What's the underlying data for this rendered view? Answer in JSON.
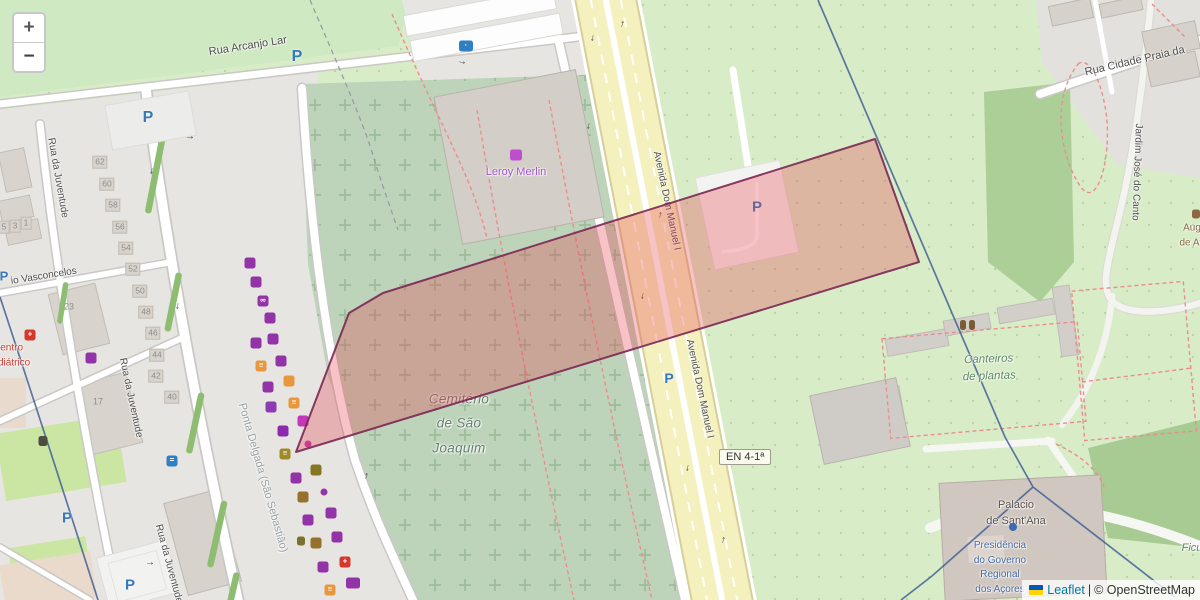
{
  "controls": {
    "zoom_in": "+",
    "zoom_out": "−"
  },
  "attribution": {
    "leaflet": "Leaflet",
    "separator": "|",
    "copyright": "© OpenStreetMap"
  },
  "badge": {
    "text": "EN 4-1ª"
  },
  "glyphs": {
    "parking": "P",
    "arrow": "→"
  },
  "colors": {
    "highlight_fill": "rgba(229,62,74,0.31)",
    "highlight_stroke": "rgba(122,39,83,0.9)",
    "boundary_blue": "#3a5a92",
    "road_yellow": "#f5f1bf",
    "parking_blue": "#3579bc",
    "shop_purple": "#9333a8",
    "food_orange": "#e8973c",
    "health_red": "#d6372c"
  },
  "labels": [
    {
      "name": "street-label-rua-arcanjo-lar",
      "text": "Rua Arcanjo Lar",
      "x": 248,
      "y": 47,
      "rot": -9,
      "size": 11
    },
    {
      "name": "street-label-rua-da-juventude-1",
      "text": "Rua da Juventude",
      "x": 57,
      "y": 178,
      "rot": 80,
      "size": 10
    },
    {
      "name": "street-label-rua-da-juventude-2",
      "text": "Rua da Juventude",
      "x": 130,
      "y": 398,
      "rot": 78,
      "size": 10
    },
    {
      "name": "street-label-rua-da-juventude-3",
      "text": "Rua da Juventude",
      "x": 168,
      "y": 564,
      "rot": 75,
      "size": 10
    },
    {
      "name": "street-label-vasconcelos",
      "text": "io Vasconcelos",
      "x": 44,
      "y": 277,
      "rot": -9,
      "size": 10
    },
    {
      "name": "poi-label-centro-pediatrico",
      "text": "Centro\nPediátrico",
      "x": 8,
      "y": 356,
      "rot": 0,
      "size": 10,
      "color": "#cc3a33",
      "cls": "tight"
    },
    {
      "name": "poi-label-leroy-merlin",
      "text": "Leroy Merlin",
      "x": 516,
      "y": 173,
      "rot": 0,
      "size": 11,
      "color": "#a055c8"
    },
    {
      "name": "area-label-cemiterio",
      "text": "Cemitério\nde São\nJoaquim",
      "x": 459,
      "y": 424,
      "rot": 0,
      "size": 13.5,
      "color": "#66806f",
      "cls": "italic cem-lbl"
    },
    {
      "name": "street-label-avenida-dom-manuel-1",
      "text": "Avenida Dom Manuel I",
      "x": 666,
      "y": 201,
      "rot": 78,
      "size": 10
    },
    {
      "name": "street-label-avenida-dom-manuel-2",
      "text": "Avenida Dom Manuel I",
      "x": 699,
      "y": 389,
      "rot": 78,
      "size": 10
    },
    {
      "name": "area-label-canteiros",
      "text": "Canteiros\nde plantas",
      "x": 989,
      "y": 368,
      "rot": -2,
      "size": 11.5,
      "color": "#5d8a60",
      "cls": "italic"
    },
    {
      "name": "street-label-rua-cidade-praia",
      "text": "Rua Cidade Praia da",
      "x": 1135,
      "y": 62,
      "rot": -13,
      "size": 11
    },
    {
      "name": "street-label-jardim-jose-do-canto",
      "text": "Jardim José do Canto",
      "x": 1136,
      "y": 172,
      "rot": 92,
      "size": 10
    },
    {
      "name": "poi-label-aug-de-atl",
      "text": "Aug\nde Atl",
      "x": 1192,
      "y": 236,
      "rot": 0,
      "size": 10,
      "color": "#8a6a45"
    },
    {
      "name": "poi-label-palacio",
      "text": "Palácio\nde Sant'Ana",
      "x": 1016,
      "y": 514,
      "rot": 0,
      "size": 11,
      "color": "#575048"
    },
    {
      "name": "poi-label-presidencia",
      "text": "Presidência\ndo Governo\nRegional\ndos Açores",
      "x": 1000,
      "y": 568,
      "rot": 0,
      "size": 10,
      "color": "#46699e",
      "cls": "tight"
    },
    {
      "name": "area-label-ponta-delgada",
      "text": "Ponta Delgada (São Sebastião)",
      "x": 262,
      "y": 478,
      "rot": 74,
      "size": 11,
      "color": "#9aa0a2"
    },
    {
      "name": "area-label-ficus",
      "text": "Ficu",
      "x": 1192,
      "y": 549,
      "rot": 0,
      "size": 11,
      "color": "#5f8a60",
      "cls": "italic"
    }
  ],
  "house_numbers": [
    {
      "name": "house-number",
      "text": "62",
      "x": 100,
      "y": 162
    },
    {
      "name": "house-number",
      "text": "60",
      "x": 107,
      "y": 184
    },
    {
      "name": "house-number",
      "text": "58",
      "x": 113,
      "y": 205
    },
    {
      "name": "house-number",
      "text": "56",
      "x": 120,
      "y": 227
    },
    {
      "name": "house-number",
      "text": "54",
      "x": 126,
      "y": 248
    },
    {
      "name": "house-number",
      "text": "52",
      "x": 133,
      "y": 269
    },
    {
      "name": "house-number",
      "text": "50",
      "x": 140,
      "y": 291
    },
    {
      "name": "house-number",
      "text": "48",
      "x": 146,
      "y": 312
    },
    {
      "name": "house-number",
      "text": "46",
      "x": 153,
      "y": 333
    },
    {
      "name": "house-number",
      "text": "44",
      "x": 157,
      "y": 355
    },
    {
      "name": "house-number",
      "text": "42",
      "x": 156,
      "y": 376
    },
    {
      "name": "house-number",
      "text": "40",
      "x": 172,
      "y": 397
    },
    {
      "name": "house-number",
      "text": "23",
      "x": 69,
      "y": 307,
      "cls": "numplain"
    },
    {
      "name": "house-number",
      "text": "17",
      "x": 98,
      "y": 402,
      "cls": "numplain"
    },
    {
      "name": "house-number",
      "text": "5",
      "x": 4,
      "y": 227
    },
    {
      "name": "house-number",
      "text": "3",
      "x": 15,
      "y": 226
    },
    {
      "name": "house-number",
      "text": "1",
      "x": 26,
      "y": 223
    }
  ],
  "parking_icons": [
    {
      "name": "parking-icon",
      "x": 148,
      "y": 118,
      "size": 16
    },
    {
      "name": "parking-icon",
      "x": 297,
      "y": 57,
      "size": 16
    },
    {
      "name": "parking-icon",
      "x": 4,
      "y": 276,
      "size": 13
    },
    {
      "name": "parking-icon",
      "x": 67,
      "y": 518,
      "size": 15
    },
    {
      "name": "parking-icon",
      "x": 130,
      "y": 585,
      "size": 15
    },
    {
      "name": "parking-icon",
      "x": 669,
      "y": 378,
      "size": 14
    },
    {
      "name": "parking-icon",
      "x": 757,
      "y": 207,
      "size": 15
    }
  ],
  "poi_icons": [
    {
      "name": "laundry-icon",
      "x": 250,
      "y": 263,
      "bg": "#9333a8"
    },
    {
      "name": "shop-bag-icon",
      "x": 256,
      "y": 282,
      "bg": "#9333a8"
    },
    {
      "name": "optician-icon",
      "x": 263,
      "y": 301,
      "bg": "#9333a8",
      "ch": "∞"
    },
    {
      "name": "clothes-shop-icon",
      "x": 270,
      "y": 318,
      "bg": "#9333a8"
    },
    {
      "name": "medical-shop-icon",
      "x": 256,
      "y": 343,
      "bg": "#9333a8"
    },
    {
      "name": "clothes-shop-icon",
      "x": 273,
      "y": 339,
      "bg": "#9333a8"
    },
    {
      "name": "fast-food-icon",
      "x": 261,
      "y": 366,
      "bg": "#e8973c",
      "ch": "≡"
    },
    {
      "name": "book-shop-icon",
      "x": 281,
      "y": 361,
      "bg": "#9333a8"
    },
    {
      "name": "clothes-shop-icon",
      "x": 268,
      "y": 387,
      "bg": "#9333a8"
    },
    {
      "name": "cafe-icon",
      "x": 289,
      "y": 381,
      "bg": "#e8973c"
    },
    {
      "name": "electronics-tv-icon",
      "x": 271,
      "y": 407,
      "bg": "#8d3bb0"
    },
    {
      "name": "fast-food-icon",
      "x": 294,
      "y": 403,
      "bg": "#e8973c",
      "ch": "≡"
    },
    {
      "name": "clothes-shop-icon",
      "x": 303,
      "y": 421,
      "bg": "#c238b8"
    },
    {
      "name": "clothes-shop-icon",
      "x": 283,
      "y": 431,
      "bg": "#8d2bb0"
    },
    {
      "name": "shop-dot-icon",
      "x": 308,
      "y": 444,
      "bg": "#c238b8",
      "cls": "dot",
      "w": 7,
      "h": 7
    },
    {
      "name": "fast-food-icon",
      "x": 285,
      "y": 454,
      "bg": "#a08a28",
      "ch": "≡"
    },
    {
      "name": "cinema-icon",
      "x": 316,
      "y": 470,
      "bg": "#857722"
    },
    {
      "name": "handbag-shop-icon",
      "x": 296,
      "y": 478,
      "bg": "#9333a8"
    },
    {
      "name": "restaurant-icon",
      "x": 303,
      "y": 497,
      "bg": "#96702c"
    },
    {
      "name": "shop-dot-icon",
      "x": 324,
      "y": 492,
      "bg": "#9333a8",
      "cls": "dot",
      "w": 7,
      "h": 7
    },
    {
      "name": "supermarket-cart-icon",
      "x": 331,
      "y": 513,
      "bg": "#9333a8"
    },
    {
      "name": "jewelry-ring-icon",
      "x": 308,
      "y": 520,
      "bg": "#9333a8"
    },
    {
      "name": "waste-basket-icon",
      "x": 301,
      "y": 541,
      "bg": "#79712c",
      "w": 8,
      "h": 9
    },
    {
      "name": "restaurant-icon",
      "x": 316,
      "y": 543,
      "bg": "#96702c"
    },
    {
      "name": "pet-shop-icon",
      "x": 337,
      "y": 537,
      "bg": "#9333a8"
    },
    {
      "name": "florist-icon",
      "x": 323,
      "y": 567,
      "bg": "#9333a8"
    },
    {
      "name": "pharmacy-icon",
      "x": 345,
      "y": 562,
      "bg": "#d6372c",
      "ch": "+"
    },
    {
      "name": "fast-food-icon",
      "x": 330,
      "y": 590,
      "bg": "#e8973c",
      "ch": "≡"
    },
    {
      "name": "toy-shop-icon",
      "x": 353,
      "y": 583,
      "bg": "#9333a8",
      "w": 14
    },
    {
      "name": "shop-icon",
      "x": 91,
      "y": 358,
      "bg": "#9333a8"
    },
    {
      "name": "hospital-icon",
      "x": 30,
      "y": 335,
      "bg": "#d6372c",
      "ch": "+"
    },
    {
      "name": "bench-icon",
      "x": 43,
      "y": 441,
      "bg": "#4c4c44",
      "w": 9,
      "h": 10
    },
    {
      "name": "bus-stop-icon",
      "x": 172,
      "y": 461,
      "bg": "#2f7fc2",
      "ch": "="
    },
    {
      "name": "charging-station-icon",
      "x": 466,
      "y": 46,
      "bg": "#2f7fc2",
      "ch": "·",
      "w": 14
    },
    {
      "name": "leroy-merlin-icon",
      "x": 516,
      "y": 155,
      "bg": "#bf4ecc",
      "w": 12,
      "h": 11
    },
    {
      "name": "garden-plants-icon",
      "x": 963,
      "y": 325,
      "bg": "#7a5c33",
      "w": 6,
      "h": 10
    },
    {
      "name": "garden-plants-icon",
      "x": 972,
      "y": 325,
      "bg": "#7a5c33",
      "w": 6,
      "h": 10
    },
    {
      "name": "edge-poi-icon",
      "x": 1196,
      "y": 214,
      "bg": "#8a6a45",
      "w": 8,
      "h": 9
    },
    {
      "name": "viewpoint-dot-icon",
      "x": 1013,
      "y": 527,
      "bg": "#3b6bb5",
      "cls": "dot",
      "w": 8,
      "h": 8
    }
  ],
  "arrows": [
    {
      "name": "oneway-arrow",
      "x": 593,
      "y": 38,
      "rot": 100
    },
    {
      "name": "oneway-arrow",
      "x": 622,
      "y": 24,
      "rot": -78
    },
    {
      "name": "oneway-arrow",
      "x": 589,
      "y": 126,
      "rot": 100
    },
    {
      "name": "oneway-arrow",
      "x": 660,
      "y": 215,
      "rot": -78
    },
    {
      "name": "oneway-arrow",
      "x": 643,
      "y": 296,
      "rot": 100
    },
    {
      "name": "oneway-arrow",
      "x": 688,
      "y": 468,
      "rot": 100
    },
    {
      "name": "oneway-arrow",
      "x": 723,
      "y": 540,
      "rot": -78
    },
    {
      "name": "oneway-arrow",
      "x": 190,
      "y": 137,
      "rot": 2
    },
    {
      "name": "oneway-arrow",
      "x": 152,
      "y": 171,
      "rot": 100
    },
    {
      "name": "oneway-arrow",
      "x": 178,
      "y": 306,
      "rot": 100
    },
    {
      "name": "oneway-arrow",
      "x": 366,
      "y": 476,
      "rot": -80
    },
    {
      "name": "oneway-arrow",
      "x": 462,
      "y": 62,
      "rot": 10
    },
    {
      "name": "oneway-arrow",
      "x": 150,
      "y": 563,
      "rot": 2
    }
  ]
}
